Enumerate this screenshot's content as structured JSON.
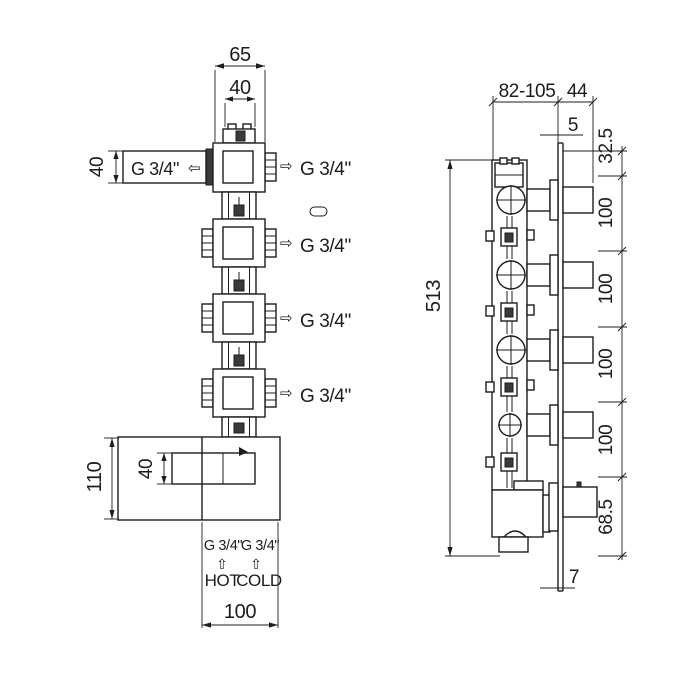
{
  "drawing": {
    "background_color": "#ffffff",
    "line_color": "#1c1c1c",
    "front_view": {
      "dims": {
        "body_width": "65",
        "connector_width": "40",
        "inlet_size": "40",
        "box_height": "110",
        "cartridge_height": "40",
        "box_width": "100"
      },
      "inlet": {
        "label": "G 3/4\"",
        "arrow": "⇦"
      },
      "outlets": [
        {
          "arrow": "⇨",
          "label": "G 3/4\""
        },
        {
          "arrow": "⇨",
          "label": "G 3/4\""
        },
        {
          "arrow": "⇨",
          "label": "G 3/4\""
        },
        {
          "arrow": "⇨",
          "label": "G 3/4\""
        }
      ],
      "supply": {
        "hot_thread": "G 3/4\"",
        "cold_thread": "G 3/4\"",
        "hot_arrow": "⇧",
        "cold_arrow": "⇧",
        "hot_label": "HOT",
        "cold_label": "COLD"
      }
    },
    "side_view": {
      "dims": {
        "depth_range": "82-105",
        "handle_depth": "44",
        "plate_thickness_top": "5",
        "top_offset": "32.5",
        "spacing": [
          "100",
          "100",
          "100",
          "100"
        ],
        "bottom_offset": "68.5",
        "total_height": "513",
        "plate_thickness_bottom": "7"
      }
    }
  }
}
